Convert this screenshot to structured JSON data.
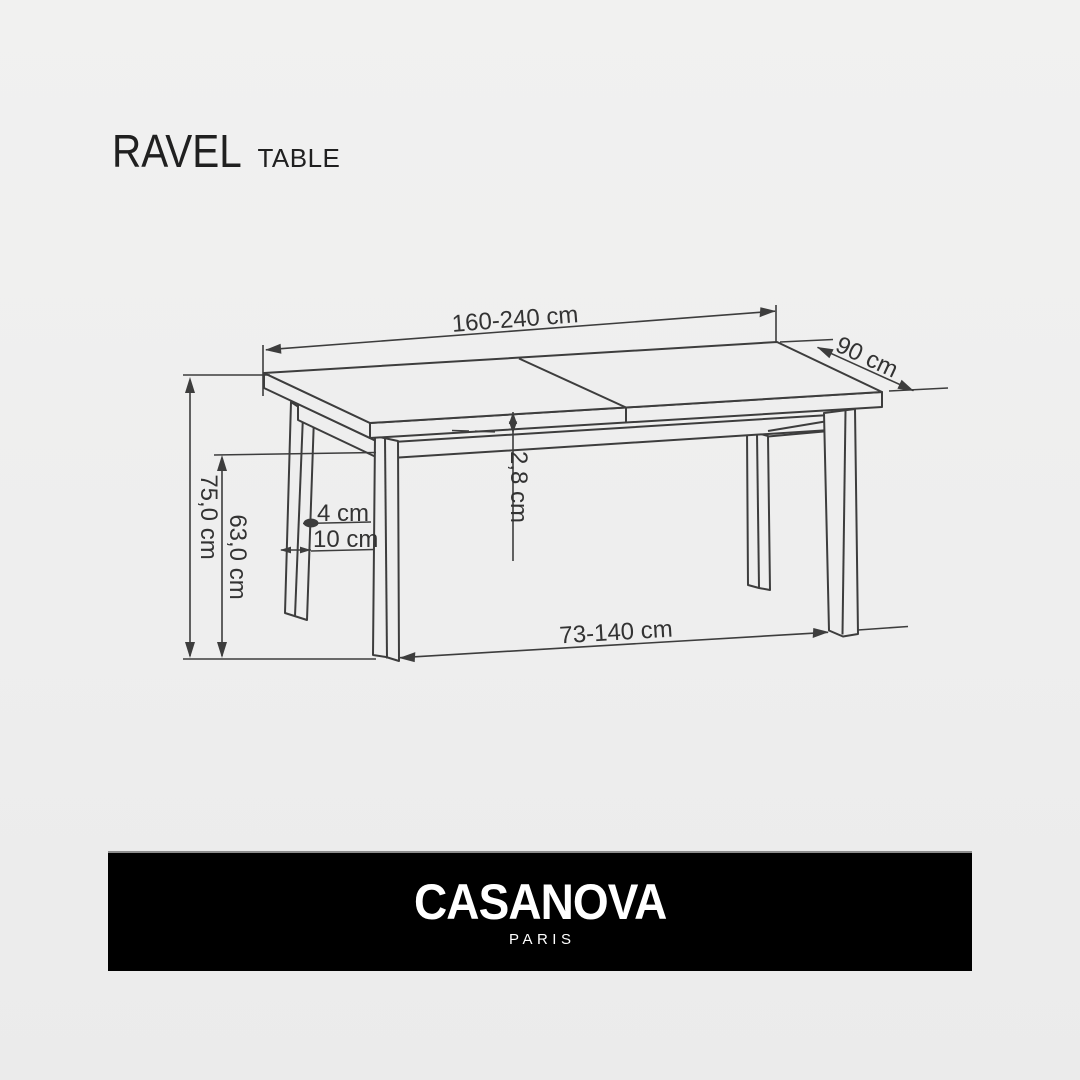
{
  "theme": {
    "page_bg": "#eeeeee",
    "line_color": "#3d3d3d",
    "label_color": "#333333",
    "title_color": "#202020",
    "banner_bg": "#000000",
    "banner_text": "#ffffff",
    "banner_border": "#8e8e8e"
  },
  "title": {
    "product": "RAVEL",
    "category": "TABLE"
  },
  "diagram": {
    "subject": "extendable-dining-table-technical-drawing",
    "labels": {
      "length": "160-240 cm",
      "depth": "90 cm",
      "height": "75,0 cm",
      "apron_clearance": "63,0 cm",
      "top_thickness": "2,8 cm",
      "leg_width": "4 cm",
      "leg_depth": "10 cm",
      "leg_span": "73-140 cm"
    }
  },
  "footer": {
    "brand": "CASANOVA",
    "city": "PARIS"
  }
}
